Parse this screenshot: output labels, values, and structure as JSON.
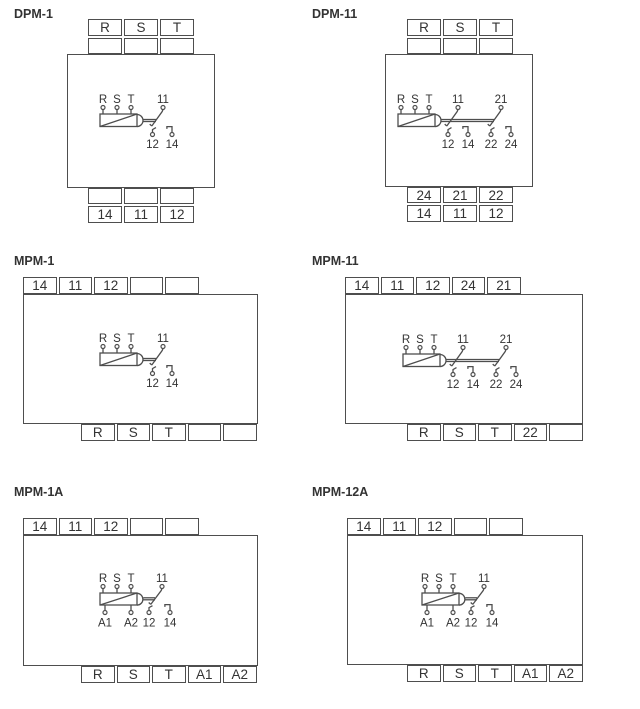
{
  "page": {
    "background": "#ffffff",
    "line_color": "#4e4e4e",
    "text_color": "#333333"
  },
  "units": [
    {
      "title": "DPM-1",
      "top_rows": [
        [
          "R",
          "S",
          "T"
        ],
        [
          "",
          "",
          ""
        ]
      ],
      "bottom_rows": [
        [
          "",
          "",
          ""
        ],
        [
          "14",
          "11",
          "12"
        ]
      ],
      "circuit": {
        "inputs": [
          "R",
          "S",
          "T"
        ],
        "c1": {
          "com": "11",
          "nc": "12",
          "no": "14"
        }
      }
    },
    {
      "title": "DPM-11",
      "top_rows": [
        [
          "R",
          "S",
          "T"
        ],
        [
          "",
          "",
          ""
        ]
      ],
      "bottom_rows": [
        [
          "24",
          "21",
          "22"
        ],
        [
          "14",
          "11",
          "12"
        ]
      ],
      "circuit": {
        "inputs": [
          "R",
          "S",
          "T"
        ],
        "c1": {
          "com": "11",
          "nc": "12",
          "no": "14"
        },
        "c2": {
          "com": "21",
          "nc": "22",
          "no": "24"
        }
      }
    },
    {
      "title": "MPM-1",
      "top_strip": [
        "14",
        "11",
        "12",
        "",
        ""
      ],
      "bottom_strip": [
        "R",
        "S",
        "T",
        "",
        ""
      ],
      "circuit": {
        "inputs": [
          "R",
          "S",
          "T"
        ],
        "c1": {
          "com": "11",
          "nc": "12",
          "no": "14"
        }
      }
    },
    {
      "title": "MPM-11",
      "top_strip": [
        "14",
        "11",
        "12",
        "24",
        "21"
      ],
      "bottom_strip": [
        "R",
        "S",
        "T",
        "22",
        ""
      ],
      "circuit": {
        "inputs": [
          "R",
          "S",
          "T"
        ],
        "c1": {
          "com": "11",
          "nc": "12",
          "no": "14"
        },
        "c2": {
          "com": "21",
          "nc": "22",
          "no": "24"
        }
      }
    },
    {
      "title": "MPM-1A",
      "top_strip": [
        "14",
        "11",
        "12",
        "",
        ""
      ],
      "bottom_strip": [
        "R",
        "S",
        "T",
        "A1",
        "A2"
      ],
      "circuit": {
        "inputs": [
          "R",
          "S",
          "T"
        ],
        "aux": [
          "A1",
          "A2"
        ],
        "c1": {
          "com": "11",
          "nc": "12",
          "no": "14"
        }
      }
    },
    {
      "title": "MPM-12A",
      "top_strip": [
        "14",
        "11",
        "12",
        "",
        ""
      ],
      "bottom_strip": [
        "R",
        "S",
        "T",
        "A1",
        "A2"
      ],
      "circuit": {
        "inputs": [
          "R",
          "S",
          "T"
        ],
        "aux": [
          "A1",
          "A2"
        ],
        "c1": {
          "com": "11",
          "nc": "12",
          "no": "14"
        }
      }
    }
  ]
}
